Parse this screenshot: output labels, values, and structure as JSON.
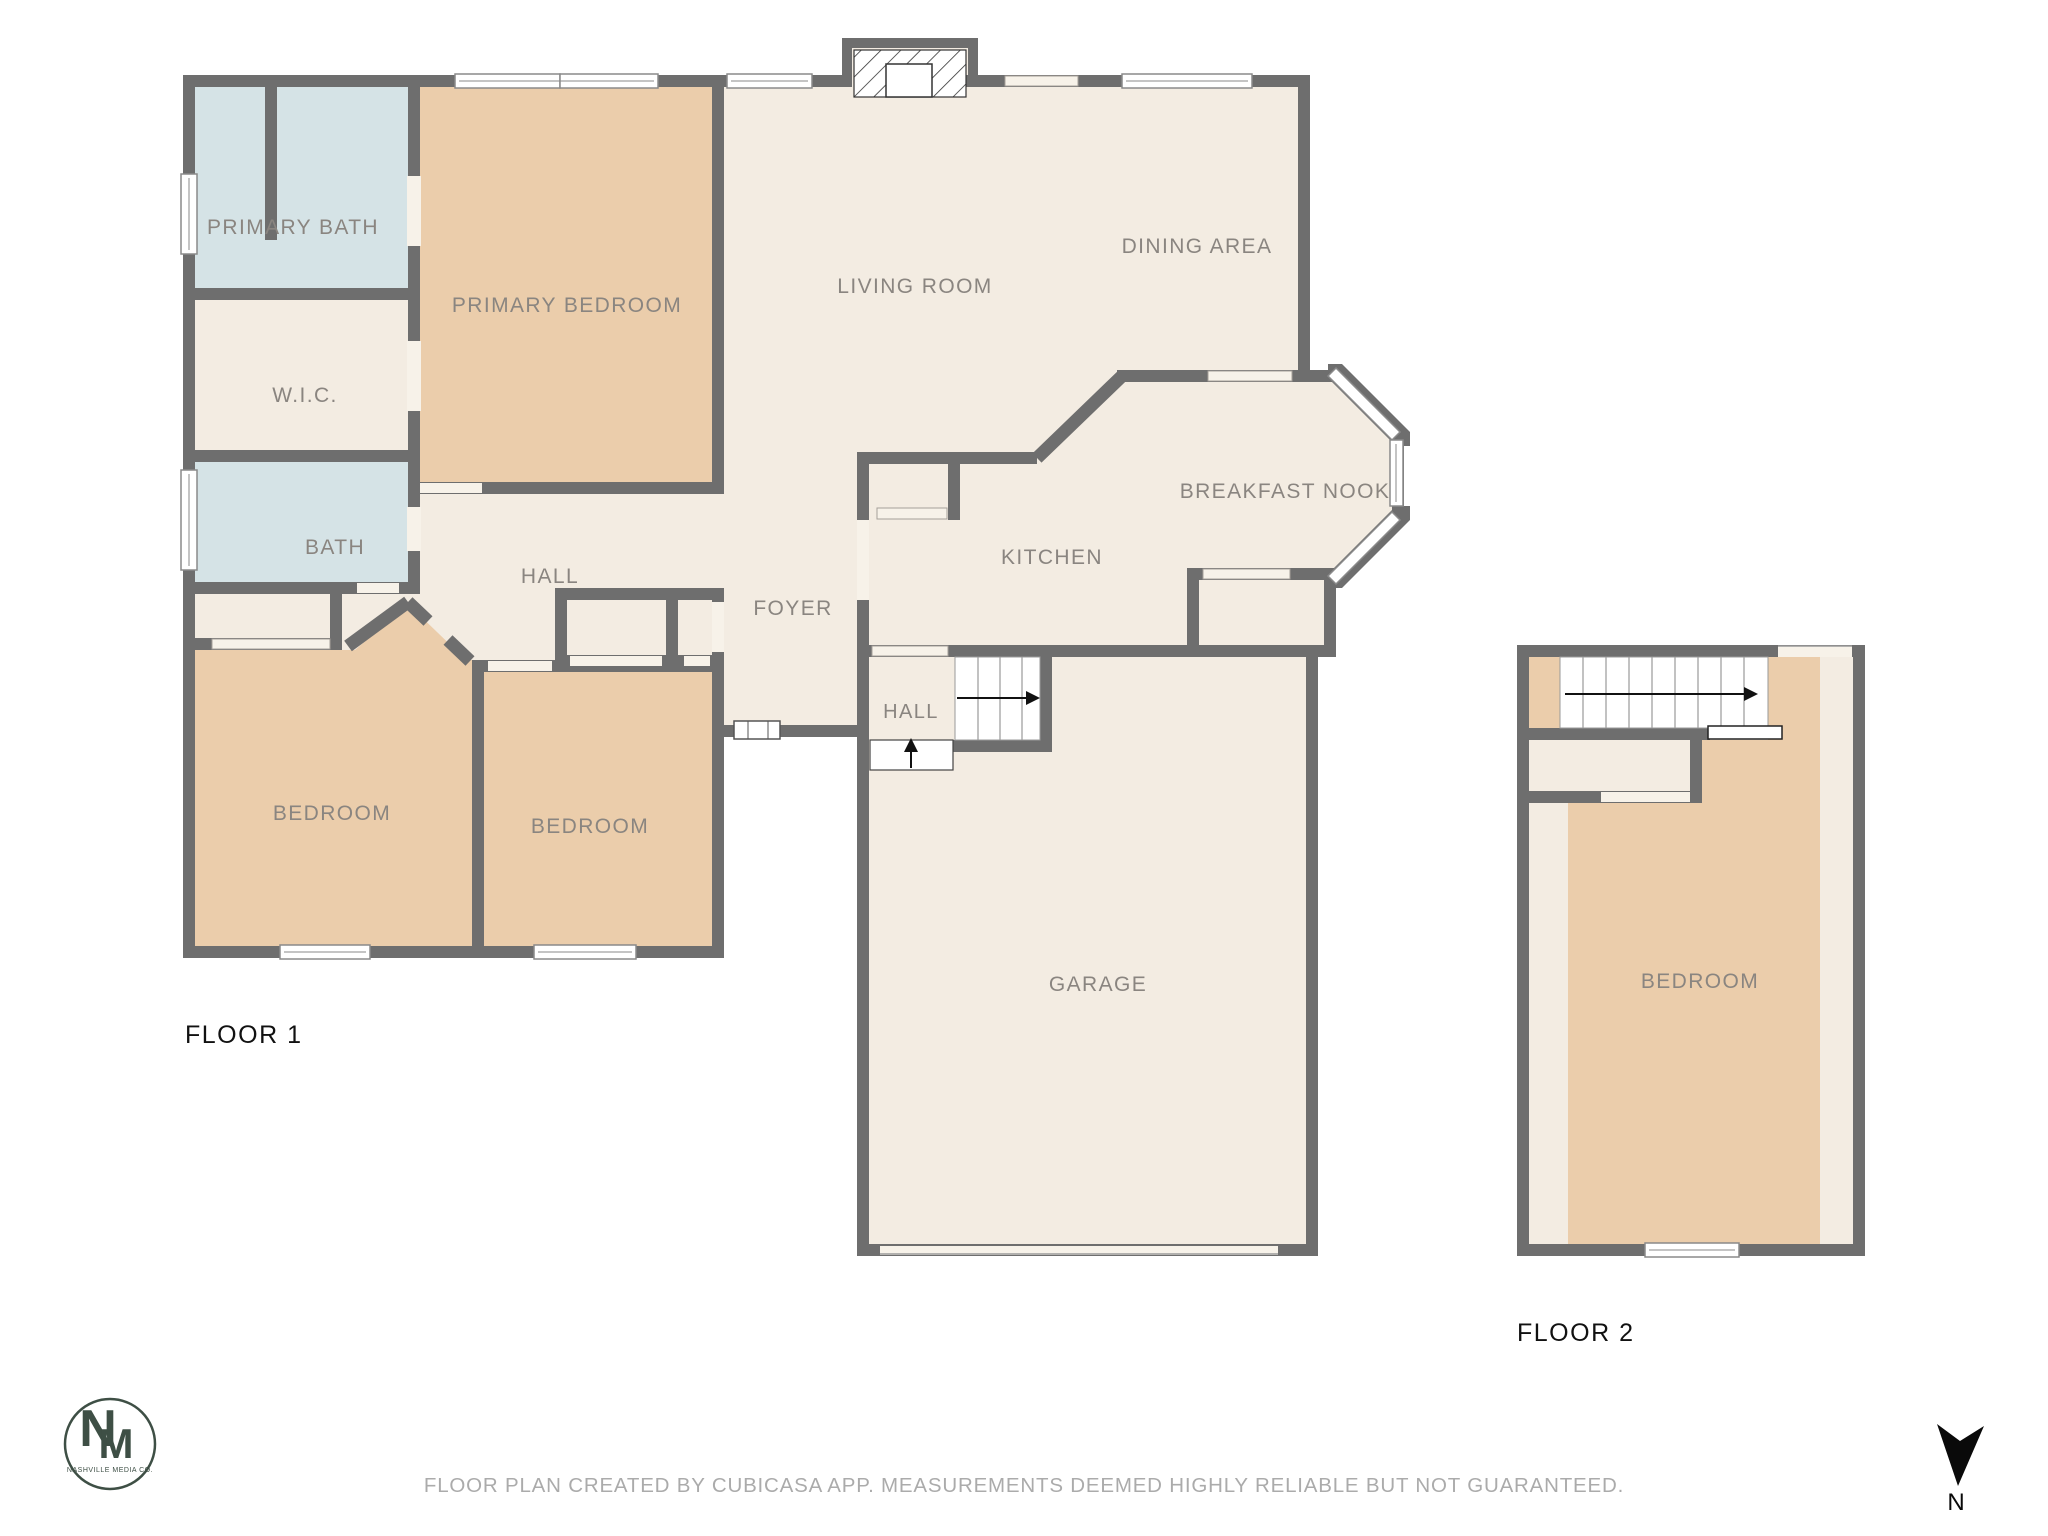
{
  "floor1": {
    "title": "FLOOR 1",
    "rooms": {
      "primary_bath": "PRIMARY BATH",
      "primary_bedroom": "PRIMARY BEDROOM",
      "wic": "W.I.C.",
      "bath": "BATH",
      "hall_bedrooms": "HALL",
      "bedroom_left": "BEDROOM",
      "bedroom_right": "BEDROOM",
      "foyer": "FOYER",
      "living_room": "LIVING ROOM",
      "dining_area": "DINING AREA",
      "breakfast_nook": "BREAKFAST NOOK",
      "kitchen": "KITCHEN",
      "hall_garage": "HALL",
      "garage": "GARAGE"
    }
  },
  "floor2": {
    "title": "FLOOR 2",
    "rooms": {
      "bedroom": "BEDROOM"
    }
  },
  "footer": {
    "caption": "FLOOR PLAN CREATED BY CUBICASA APP. MEASUREMENTS DEEMED HIGHLY RELIABLE BUT NOT GUARANTEED."
  },
  "compass": {
    "north_label": "N"
  },
  "logo": {
    "letter_n": "N",
    "letter_m": "M",
    "company": "NASHVILLE MEDIA CO."
  },
  "palette": {
    "wall": "#6e6e6e",
    "cream": "#f3ece2",
    "peach": "#ebcdab",
    "bath_blue": "#d5e3e6",
    "gap": "#f7f2e9",
    "label": "#8a8580",
    "caption": "#ababab",
    "logo_green": "#3e4f45",
    "floor_label": "#111111"
  }
}
